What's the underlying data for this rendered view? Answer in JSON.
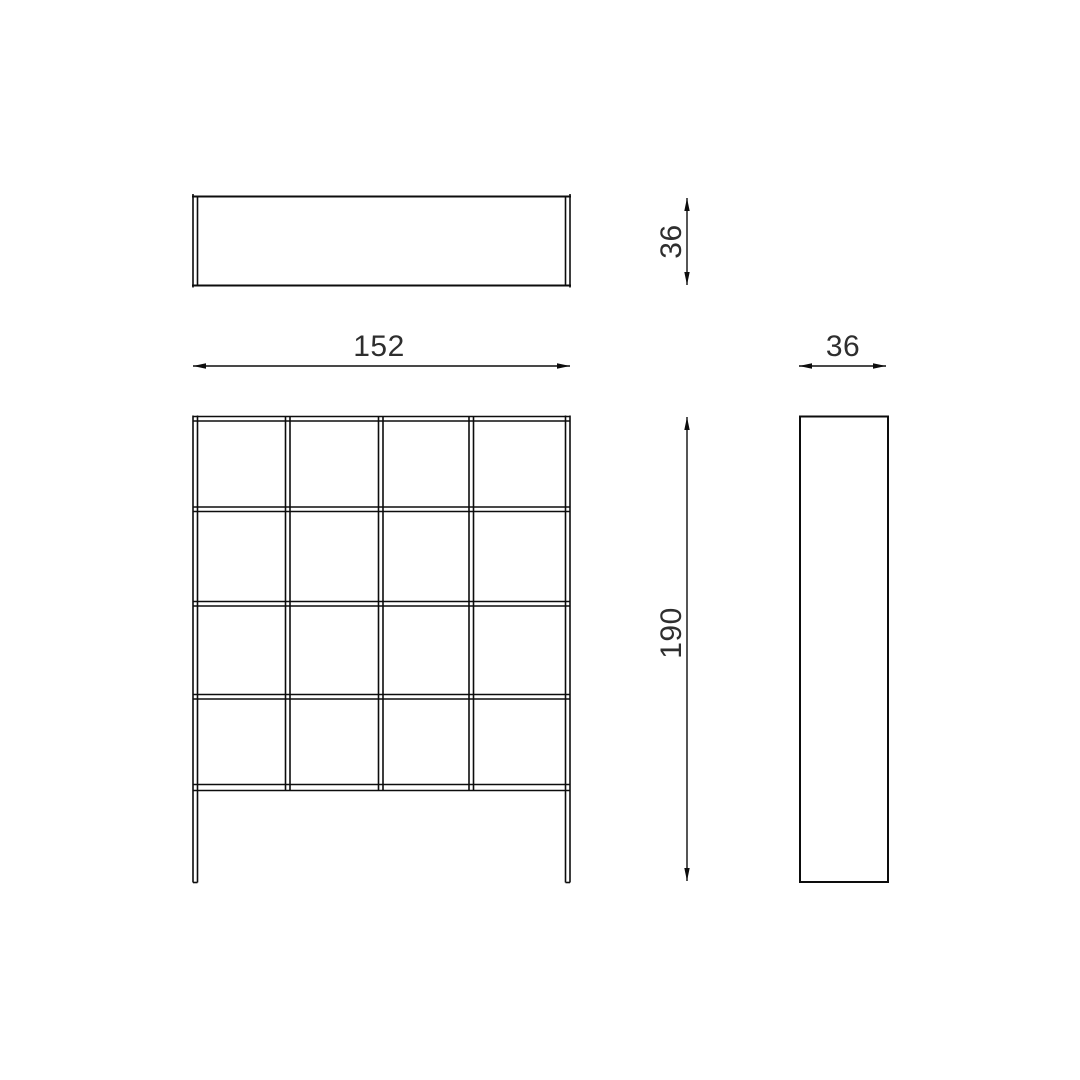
{
  "canvas": {
    "background": "#ffffff",
    "line_color": "#0d0d0d",
    "text_color": "#2e2e2e"
  },
  "drawing": {
    "front_view": {
      "columns": 4,
      "rows": 4
    },
    "dimensions": {
      "width": "152",
      "height": "190",
      "depth_top": "36",
      "depth_side": "36"
    }
  }
}
